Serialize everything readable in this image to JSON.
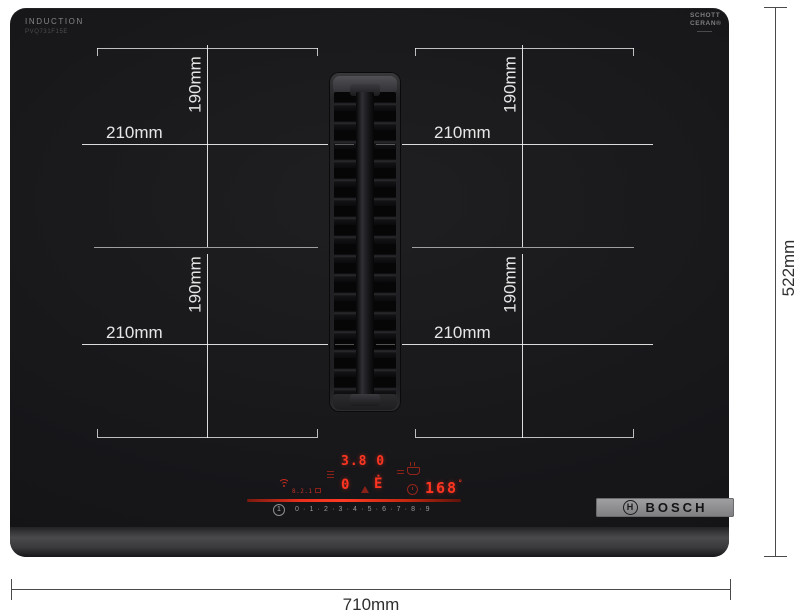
{
  "branding": {
    "induction_label": "INDUCTION",
    "model_label": "PVQ731F15E",
    "glass_line1": "SCHOTT",
    "glass_line2": "CERAN®",
    "bosch_wordmark": "BOSCH",
    "bosch_symbol_letter": "H"
  },
  "dimensions": {
    "overall_width": "710mm",
    "overall_height": "522mm",
    "zone_width": "210mm",
    "zone_height": "190mm"
  },
  "display": {
    "power_top": "3.8 0",
    "power_left": "0",
    "vent_indicator": "Ė",
    "timer": "168",
    "timer_unit_mark": "°",
    "aux_readout": "8.2.1",
    "power_scale": "0 · 1 · 2 · 3 · 4 · 5 · 6 · 7 · 8 · 9",
    "info_key": "1"
  },
  "colors": {
    "background": "#ffffff",
    "hob_surface": "#18181a",
    "zone_line": "#c8c8c8",
    "label_white": "#e6e6e6",
    "red_bright": "#ff3522",
    "red_dim": "#93241a",
    "scale_gray": "#98989a",
    "draft_line": "#4a4a4a",
    "draft_text": "#2f2f31",
    "bosch_plate": "#8f8f91"
  }
}
